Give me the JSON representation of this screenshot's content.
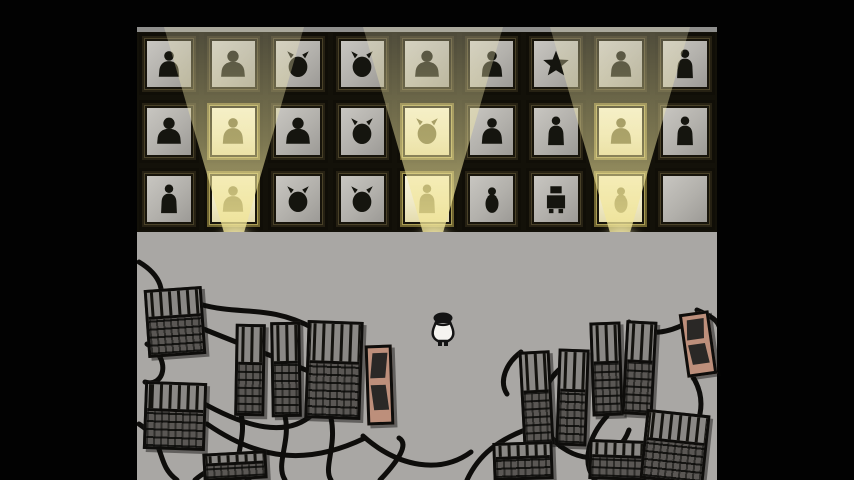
{
  "meta": {
    "scene": "Hand-drawn game room: a gallery wall of 27 framed pixel-art portraits lit by three floor spotlights, above a grey floor crowded with wired server racks and a small player character",
    "text_on_screen": "none"
  },
  "wall": {
    "rows": 3,
    "cols": 9,
    "frames": [
      {
        "row": 1,
        "col": 1,
        "figure": "person",
        "lit": false,
        "empty": false,
        "desc": "hooded figure holding a staff"
      },
      {
        "row": 1,
        "col": 2,
        "figure": "bigperson",
        "lit": false,
        "empty": false,
        "desc": "long-haired bearded man holding a jug"
      },
      {
        "row": 1,
        "col": 3,
        "figure": "creature",
        "lit": false,
        "empty": false,
        "desc": "horned viking-like creature"
      },
      {
        "row": 1,
        "col": 4,
        "figure": "creature",
        "lit": false,
        "empty": false,
        "desc": "monkey with long tail"
      },
      {
        "row": 1,
        "col": 5,
        "figure": "bigperson",
        "lit": false,
        "empty": false,
        "desc": "spiky-haired man with sunglasses"
      },
      {
        "row": 1,
        "col": 6,
        "figure": "person",
        "lit": false,
        "empty": false,
        "desc": "girl with long dark bangs"
      },
      {
        "row": 1,
        "col": 7,
        "figure": "star",
        "lit": false,
        "empty": false,
        "desc": "white star-shaped person"
      },
      {
        "row": 1,
        "col": 8,
        "figure": "person",
        "lit": false,
        "empty": false,
        "desc": "woman with horn-like hair"
      },
      {
        "row": 1,
        "col": 9,
        "figure": "tallperson",
        "lit": false,
        "empty": false,
        "desc": "tall woman with long dark hair"
      },
      {
        "row": 2,
        "col": 1,
        "figure": "bigperson",
        "lit": false,
        "empty": false,
        "desc": "shaggy-haired man with beard"
      },
      {
        "row": 2,
        "col": 2,
        "figure": "person",
        "lit": true,
        "empty": false,
        "desc": "curly-haired child, spotlit"
      },
      {
        "row": 2,
        "col": 3,
        "figure": "bigperson",
        "lit": false,
        "empty": false,
        "desc": "man in black suit"
      },
      {
        "row": 2,
        "col": 4,
        "figure": "creature",
        "lit": false,
        "empty": false,
        "desc": "bearded gnome with hands on face"
      },
      {
        "row": 2,
        "col": 5,
        "figure": "creature",
        "lit": true,
        "empty": false,
        "desc": "horned owl creature, spotlit"
      },
      {
        "row": 2,
        "col": 6,
        "figure": "person",
        "lit": false,
        "empty": false,
        "desc": "dark figure with spiked collar"
      },
      {
        "row": 2,
        "col": 7,
        "figure": "tallperson",
        "lit": false,
        "empty": false,
        "desc": "robed woman carrying a satchel"
      },
      {
        "row": 2,
        "col": 8,
        "figure": "person",
        "lit": true,
        "empty": false,
        "desc": "hooded kid with glasses, spotlit"
      },
      {
        "row": 2,
        "col": 9,
        "figure": "tallperson",
        "lit": false,
        "empty": false,
        "desc": "pale woman with very long hair"
      },
      {
        "row": 3,
        "col": 1,
        "figure": "tallperson",
        "lit": false,
        "empty": false,
        "desc": "officer with tricorn hat and coat"
      },
      {
        "row": 3,
        "col": 2,
        "figure": "person",
        "lit": true,
        "empty": false,
        "desc": "wild curly-haired creature, spotlit"
      },
      {
        "row": 3,
        "col": 3,
        "figure": "creature",
        "lit": false,
        "empty": false,
        "desc": "mustached officer with wing-like arms"
      },
      {
        "row": 3,
        "col": 4,
        "figure": "creature",
        "lit": false,
        "empty": false,
        "desc": "swan-like creature on a vase body"
      },
      {
        "row": 3,
        "col": 5,
        "figure": "tallperson",
        "lit": true,
        "empty": false,
        "desc": "bald figure in a robe, spotlit"
      },
      {
        "row": 3,
        "col": 6,
        "figure": "bird",
        "lit": false,
        "empty": false,
        "desc": "small penguin-like bird"
      },
      {
        "row": 3,
        "col": 7,
        "figure": "robot",
        "lit": false,
        "empty": false,
        "desc": "boxy robot mech"
      },
      {
        "row": 3,
        "col": 8,
        "figure": "bird",
        "lit": true,
        "empty": false,
        "desc": "bearded duck creature, spotlit"
      },
      {
        "row": 3,
        "col": 9,
        "figure": "none",
        "lit": false,
        "empty": true,
        "desc": "empty frame with blank grey mat"
      }
    ]
  },
  "spotlights": {
    "count": 3,
    "positions_x": [
      234,
      433,
      620
    ],
    "lit_columns": [
      2,
      5,
      8
    ]
  },
  "floor": {
    "character": {
      "desc": "small player character seen from behind, white coat and dark hair",
      "x": 290,
      "y": 78
    },
    "machines": [
      {
        "x": 9,
        "y": 56,
        "w": 58,
        "h": 68,
        "rot": -4,
        "variant": "rack"
      },
      {
        "x": 7,
        "y": 150,
        "w": 62,
        "h": 68,
        "rot": 2,
        "variant": "rack"
      },
      {
        "x": 66,
        "y": 220,
        "w": 64,
        "h": 28,
        "rot": -3,
        "variant": "rack"
      },
      {
        "x": 98,
        "y": 92,
        "w": 30,
        "h": 92,
        "rot": 1,
        "variant": "rack"
      },
      {
        "x": 134,
        "y": 90,
        "w": 30,
        "h": 95,
        "rot": -1,
        "variant": "rack"
      },
      {
        "x": 169,
        "y": 89,
        "w": 56,
        "h": 98,
        "rot": 2,
        "variant": "rack"
      },
      {
        "x": 229,
        "y": 113,
        "w": 27,
        "h": 80,
        "rot": -2,
        "variant": "tan"
      },
      {
        "x": 384,
        "y": 119,
        "w": 31,
        "h": 94,
        "rot": -3,
        "variant": "rack"
      },
      {
        "x": 420,
        "y": 117,
        "w": 31,
        "h": 97,
        "rot": 2,
        "variant": "rack"
      },
      {
        "x": 454,
        "y": 90,
        "w": 31,
        "h": 94,
        "rot": -2,
        "variant": "rack"
      },
      {
        "x": 487,
        "y": 89,
        "w": 31,
        "h": 94,
        "rot": 3,
        "variant": "rack"
      },
      {
        "x": 546,
        "y": 80,
        "w": 30,
        "h": 64,
        "rot": -8,
        "variant": "tan"
      },
      {
        "x": 356,
        "y": 210,
        "w": 60,
        "h": 38,
        "rot": -2,
        "variant": "rack"
      },
      {
        "x": 452,
        "y": 208,
        "w": 58,
        "h": 40,
        "rot": 2,
        "variant": "rack"
      },
      {
        "x": 506,
        "y": 180,
        "w": 64,
        "h": 70,
        "rot": 6,
        "variant": "rack"
      }
    ]
  },
  "colors": {
    "background": "#020202",
    "wall": "#131109",
    "wall_top_edge": "#8f8f8d",
    "floor": "#a9a7a4",
    "frame_wood": "#4a4229",
    "frame_wood_lit": "#ab9e55",
    "mat_unlit": "#b2b0ab",
    "mat_lit": "#f3efd8",
    "silhouette": "#15150f",
    "silhouette_lit": "#6d6637",
    "beam": "#f2e9b4",
    "machine_dark": "#55524f",
    "machine_light": "#8a8885",
    "tan_device": "#bd8f7b",
    "cable": "#0e0d0b",
    "bulb": "#f5f1d8"
  }
}
